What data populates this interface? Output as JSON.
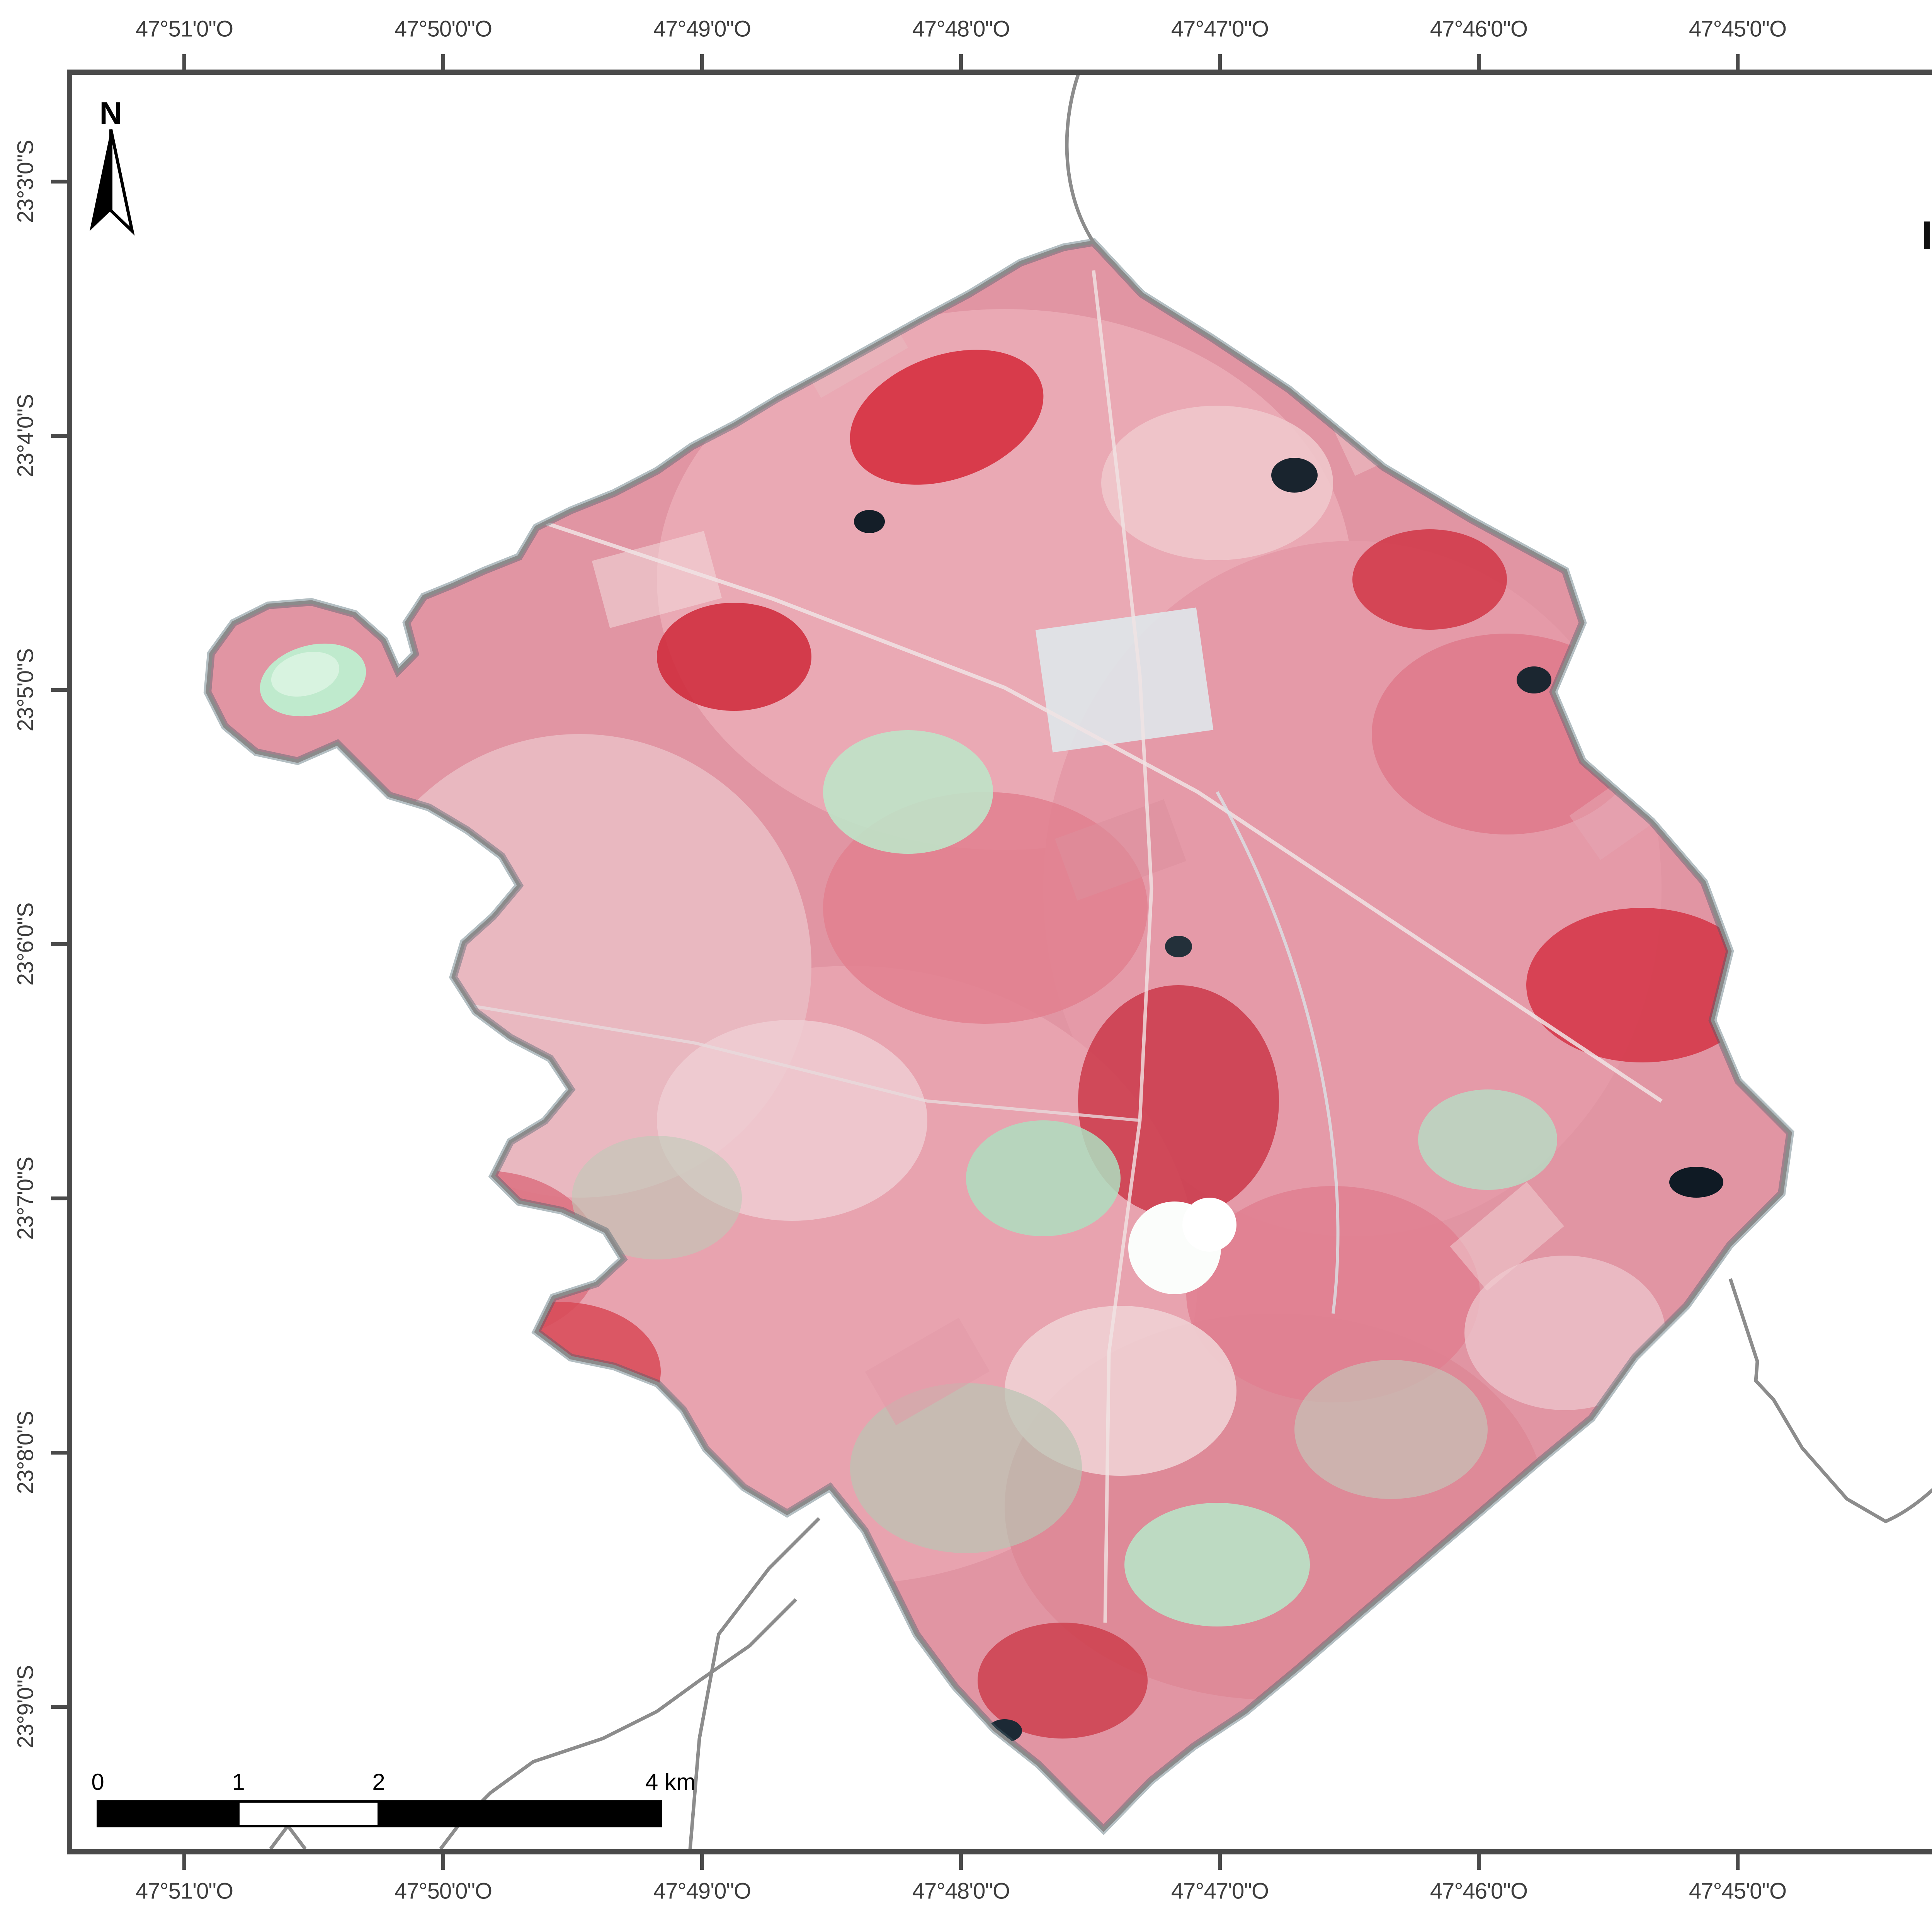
{
  "map": {
    "region_name": "Jumirim municipality false-color RapidEye mosaic",
    "boundary_color": "#8b8b8b",
    "imagery_palette": [
      "#e195a3",
      "#d62f3f",
      "#efc6cb",
      "#b9e2c6",
      "#19242e",
      "#dfe7ea"
    ]
  },
  "axes": {
    "lon_labels": [
      "47°51'0\"O",
      "47°50'0\"O",
      "47°49'0\"O",
      "47°48'0\"O",
      "47°47'0\"O",
      "47°46'0\"O",
      "47°45'0\"O",
      "47°44'0\"O"
    ],
    "lat_labels": [
      "23°3'0\"S",
      "23°4'0\"S",
      "23°5'0\"S",
      "23°6'0\"S",
      "23°7'0\"S",
      "23°8'0\"S",
      "23°9'0\"S"
    ]
  },
  "north": {
    "label": "N"
  },
  "scalebar": {
    "labels": [
      "0",
      "1",
      "2",
      "4 km"
    ]
  },
  "title_panel": {
    "line1": "PROJETO DE APOIO À",
    "line2": "IMPLANTAÇÃO DO CAR"
  },
  "subtitle_panel": {
    "municipality": "JUMIRIM - SP",
    "product": "Mosaico RapidEye"
  },
  "legend": {
    "heading": "Legenda",
    "limite_label": "Limite Municipal",
    "area_text": "Área total do município (ha): 5.675",
    "rgb_heading": "Composição RGB Falsa-cor",
    "bands": [
      {
        "channel": "Red:",
        "band": "Band_5",
        "color": "#ff0000"
      },
      {
        "channel": "Green:",
        "band": "Band_3",
        "color": "#00dd00"
      },
      {
        "channel": "Blue:",
        "band": "Band_2",
        "color": "#0000ff"
      }
    ]
  },
  "location": {
    "heading": "Localização do Município",
    "labels": {
      "ms": "MS",
      "mg": "MG",
      "pr": "PR"
    },
    "marker_color": "#ff0000",
    "ocean_color": "#cfe9f8"
  },
  "source": {
    "heading": "Fonte de Dados",
    "line1": "Imagens Rapideye - Ano 2012",
    "line2": "Sistema de Coordenadas Geográficas",
    "line3": "Datum SIRGAS 2000"
  },
  "logo": {
    "text": "fbds",
    "ellipse_color": "#2ea818",
    "bar_color": "#e8c133"
  }
}
